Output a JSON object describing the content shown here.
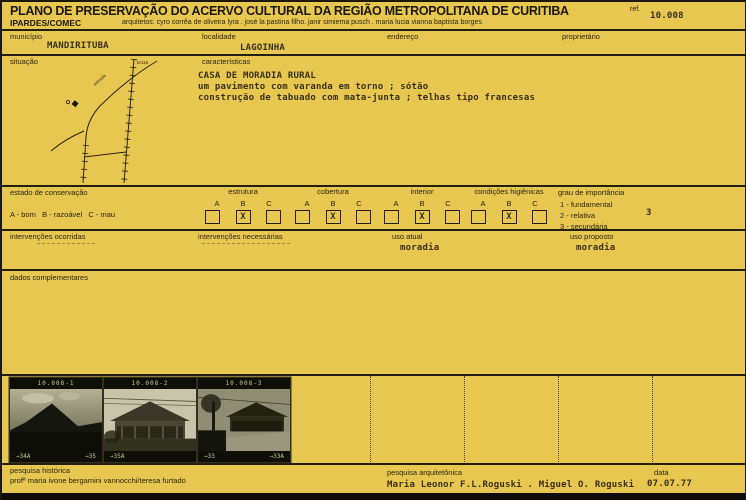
{
  "header": {
    "title": "PLANO DE PRESERVAÇÃO DO ACERVO CULTURAL DA REGIÃO METROPOLITANA DE CURITIBA",
    "org": "IPARDES/COMEC",
    "architects": "arquitetos: cyro corrêa de oliveira lyra . josé la pastina filho. janir simiema pusch . maria lucia vianna baptista borges",
    "ref_label": "ref.",
    "ref_value": "10.008"
  },
  "identification": {
    "municipio_label": "município",
    "municipio_value": "MANDIRITUBA",
    "localidade_label": "localidade",
    "localidade_value": "LAGOINHA",
    "endereco_label": "endereço",
    "endereco_value": "",
    "proprietario_label": "proprietário",
    "proprietario_value": ""
  },
  "situacao": {
    "label": "situação",
    "map_road_label": "br116",
    "map_diagonal_label": "estrada"
  },
  "caracteristicas": {
    "label": "características",
    "lines": [
      "CASA DE MORADIA RURAL",
      "um pavimento com varanda em torno ; sótão",
      "construção de tabuado com mata-junta ; telhas tipo francesas"
    ]
  },
  "conservacao": {
    "label": "estado de conservação",
    "legend": "A - bom   B - razoável   C - mau",
    "cols": [
      "A",
      "B",
      "C"
    ],
    "mark": "X",
    "groups": [
      {
        "name": "estrutura",
        "checked": "B"
      },
      {
        "name": "cobertura",
        "checked": "B"
      },
      {
        "name": "interior",
        "checked": "B"
      },
      {
        "name": "condições higiênicas",
        "checked": "B"
      }
    ]
  },
  "importancia": {
    "label": "grau de importância",
    "options": [
      "1 - fundamental",
      "2 - relativa",
      "3 - secundária"
    ],
    "value": "3"
  },
  "intervencoes": {
    "ocorridas_label": "intervenções ocorridas",
    "necessarias_label": "intervenções necessárias"
  },
  "uso": {
    "atual_label": "uso atual",
    "atual_value": "moradia",
    "proposto_label": "uso proposto",
    "proposto_value": "moradia"
  },
  "dados_complementares_label": "dados complementares",
  "photos": [
    {
      "top_label": "10.008-1",
      "frame_left": "→34A",
      "frame_right": "→35"
    },
    {
      "top_label": "10.008-2",
      "frame_left": "→35A",
      "frame_right": ""
    },
    {
      "top_label": "10.008-3",
      "frame_left": "→33",
      "frame_right": "→33A"
    }
  ],
  "footer": {
    "pesquisa_historica_label": "pesquisa histórica",
    "pesquisa_historica_value": "profª maria ivone bergamini vannocchi/teresa furtado",
    "pesquisa_arquitetonica_label": "pesquisa arquitetônica",
    "pesquisa_arquitetonica_value": "Maria Leonor F.L.Roguski . Miguel O. Roguski",
    "data_label": "data",
    "data_value": "07.07.77"
  },
  "colors": {
    "paper": "#e7c750",
    "ink": "#241f12",
    "typed_ink": "#38301d"
  }
}
